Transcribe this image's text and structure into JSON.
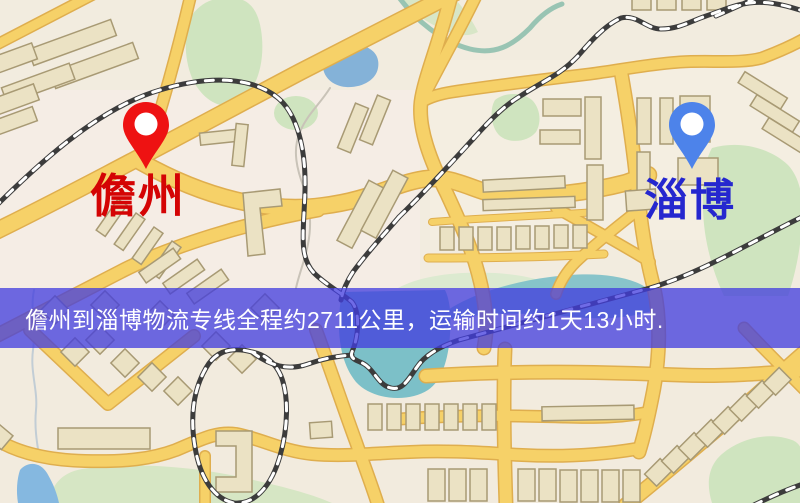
{
  "map": {
    "origin": {
      "name": "儋州",
      "pin_color": "#ee1212",
      "label_color": "#d40404"
    },
    "destination": {
      "name": "淄博",
      "pin_color": "#4d83ea",
      "label_color": "#2527cf"
    },
    "route_banner": {
      "text": "儋州到淄博物流专线全程约2711公里，运输时间约1天13小时.",
      "distance_km": "2711",
      "duration": "1天13小时",
      "overlay_color": "rgba(66,60,222,0.76)",
      "text_color": "#ffffff"
    },
    "palette": {
      "road": "#f6d168",
      "road_casing": "#dfae4e",
      "railway": "#3c3c3c",
      "water": "#84b2d8",
      "pond": "#7cc0c8",
      "park": "#cfe4bf",
      "building": "#ebe2c4",
      "background": "#f2ecdf"
    }
  }
}
